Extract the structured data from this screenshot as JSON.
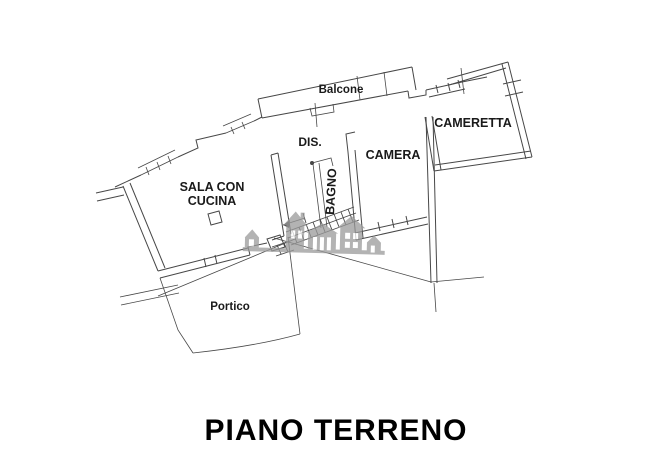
{
  "plan": {
    "title": "PIANO TERRENO",
    "labels": {
      "balcone": "Balcone",
      "dis": "DIS.",
      "cameretta": "CAMERETTA",
      "camera": "CAMERA",
      "bagno": "BAGNO",
      "sala_line1": "SALA CON",
      "sala_line2": "CUCINA",
      "portico": "Portico"
    },
    "colors": {
      "wall": "#474747",
      "label": "#1a1a1a",
      "title": "#000000",
      "watermark": "#9a9a9a",
      "background": "#ffffff"
    },
    "watermark_icon": "houses-logo-icon"
  }
}
